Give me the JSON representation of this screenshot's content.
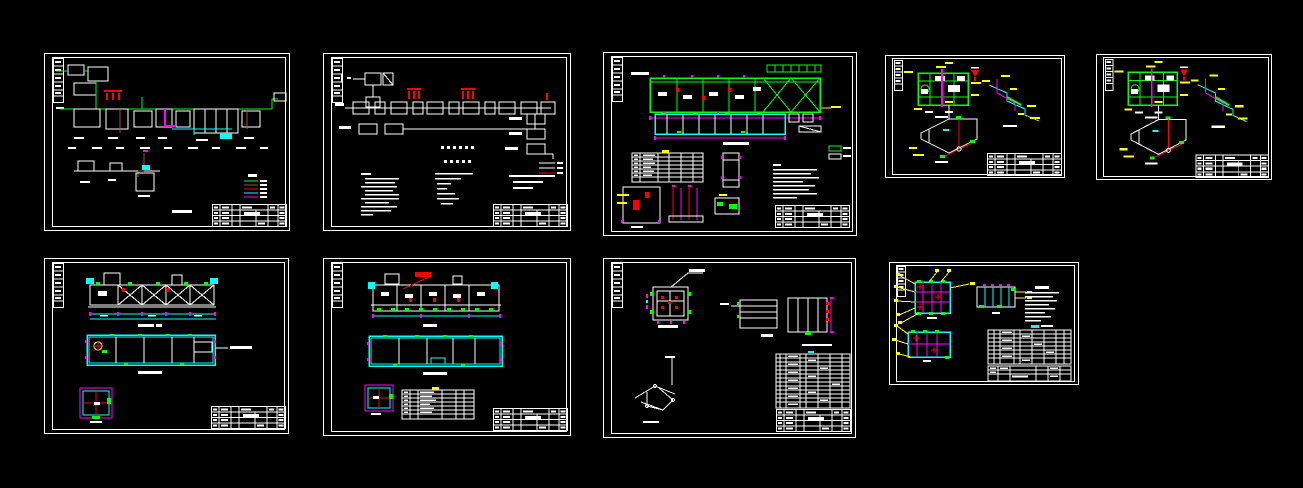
{
  "canvas": {
    "width": 1303,
    "height": 488,
    "background": "#000000"
  },
  "palette": {
    "black": "#000000",
    "white": "#ffffff",
    "green": "#00ff00",
    "cyan": "#00ffff",
    "magenta": "#ff00ff",
    "red": "#ff0000",
    "yellow": "#ffff00",
    "brown": "#9c5148"
  },
  "sheets": [
    {
      "id": "sheet-1",
      "kind": "process-flow-diagram",
      "legend": {
        "entries": [
          {
            "color": "#00ff00"
          },
          {
            "color": "#9c5148"
          },
          {
            "color": "#ff0000"
          },
          {
            "color": "#00ffff"
          },
          {
            "color": "#ff00ff"
          }
        ]
      }
    },
    {
      "id": "sheet-2",
      "kind": "block-flow-diagram",
      "legend": {
        "entries": [
          {
            "color": "#ffffff"
          },
          {
            "color": "#ffffff"
          },
          {
            "color": "#ff0000"
          }
        ]
      }
    },
    {
      "id": "sheet-3",
      "kind": "plant-plan-layout",
      "legend": {
        "entries": [
          {
            "color": "#00ff00"
          },
          {
            "color": "#ffffff"
          }
        ]
      }
    },
    {
      "id": "sheet-4",
      "kind": "pump-room-piping-plan-and-isometrics"
    },
    {
      "id": "sheet-5",
      "kind": "pump-room-piping-plan-and-isometrics"
    },
    {
      "id": "sheet-6",
      "kind": "tank-longitudinal-sections"
    },
    {
      "id": "sheet-7",
      "kind": "tank-longitudinal-sections-with-schedule"
    },
    {
      "id": "sheet-8",
      "kind": "details-and-equipment-schedule"
    },
    {
      "id": "sheet-9",
      "kind": "grid-plan-details-with-callouts"
    }
  ]
}
